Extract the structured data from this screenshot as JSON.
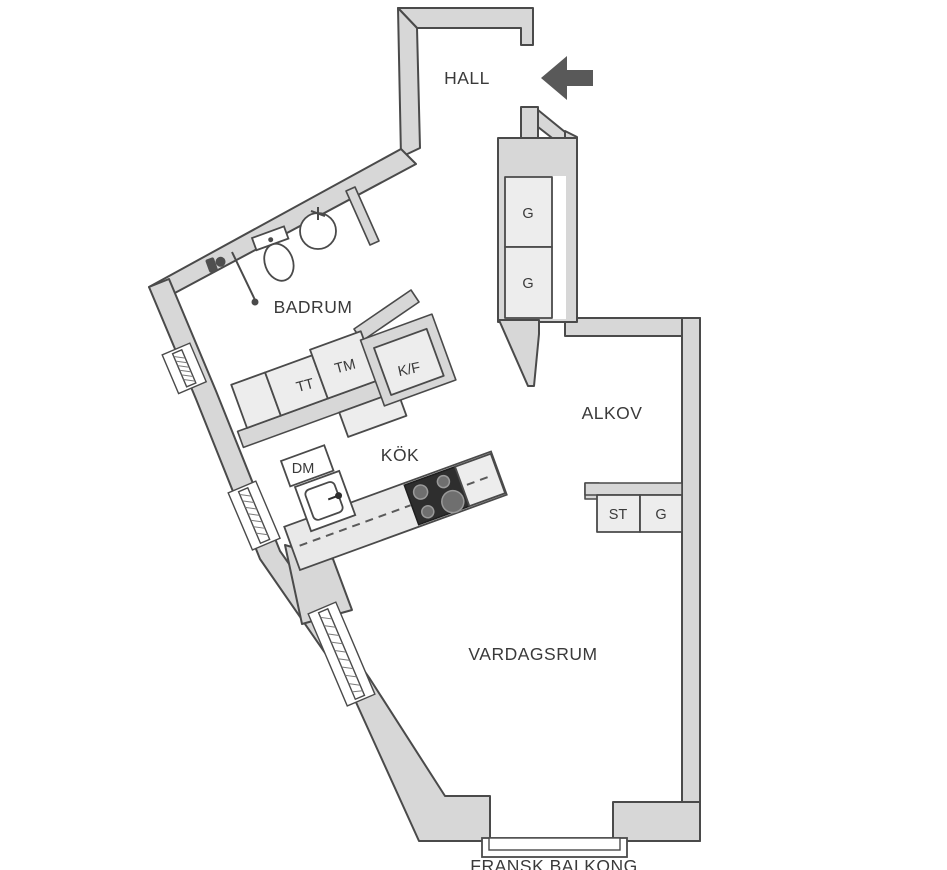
{
  "plan": {
    "title": "apartment-floor-plan",
    "rooms": {
      "hall": "HALL",
      "badrum": "BADRUM",
      "alkov": "ALKOV",
      "kok": "KÖK",
      "vardagsrum": "VARDAGSRUM",
      "balkong": "FRANSK BALKONG"
    },
    "closets": {
      "g_upper": "G",
      "g_lower": "G",
      "st": "ST",
      "g_alkov": "G"
    },
    "appliances": {
      "tt": "TT",
      "tm": "TM",
      "kf": "K/F",
      "dm": "DM"
    },
    "colors": {
      "wall_fill": "#d7d7d7",
      "wall_stroke": "#4a4a4a",
      "fixture_fill": "#ededed",
      "counter_fill": "#e9e9e9",
      "stove_fill": "#2e2e2e",
      "text": "#3a3a3a",
      "arrow": "#595959"
    }
  }
}
